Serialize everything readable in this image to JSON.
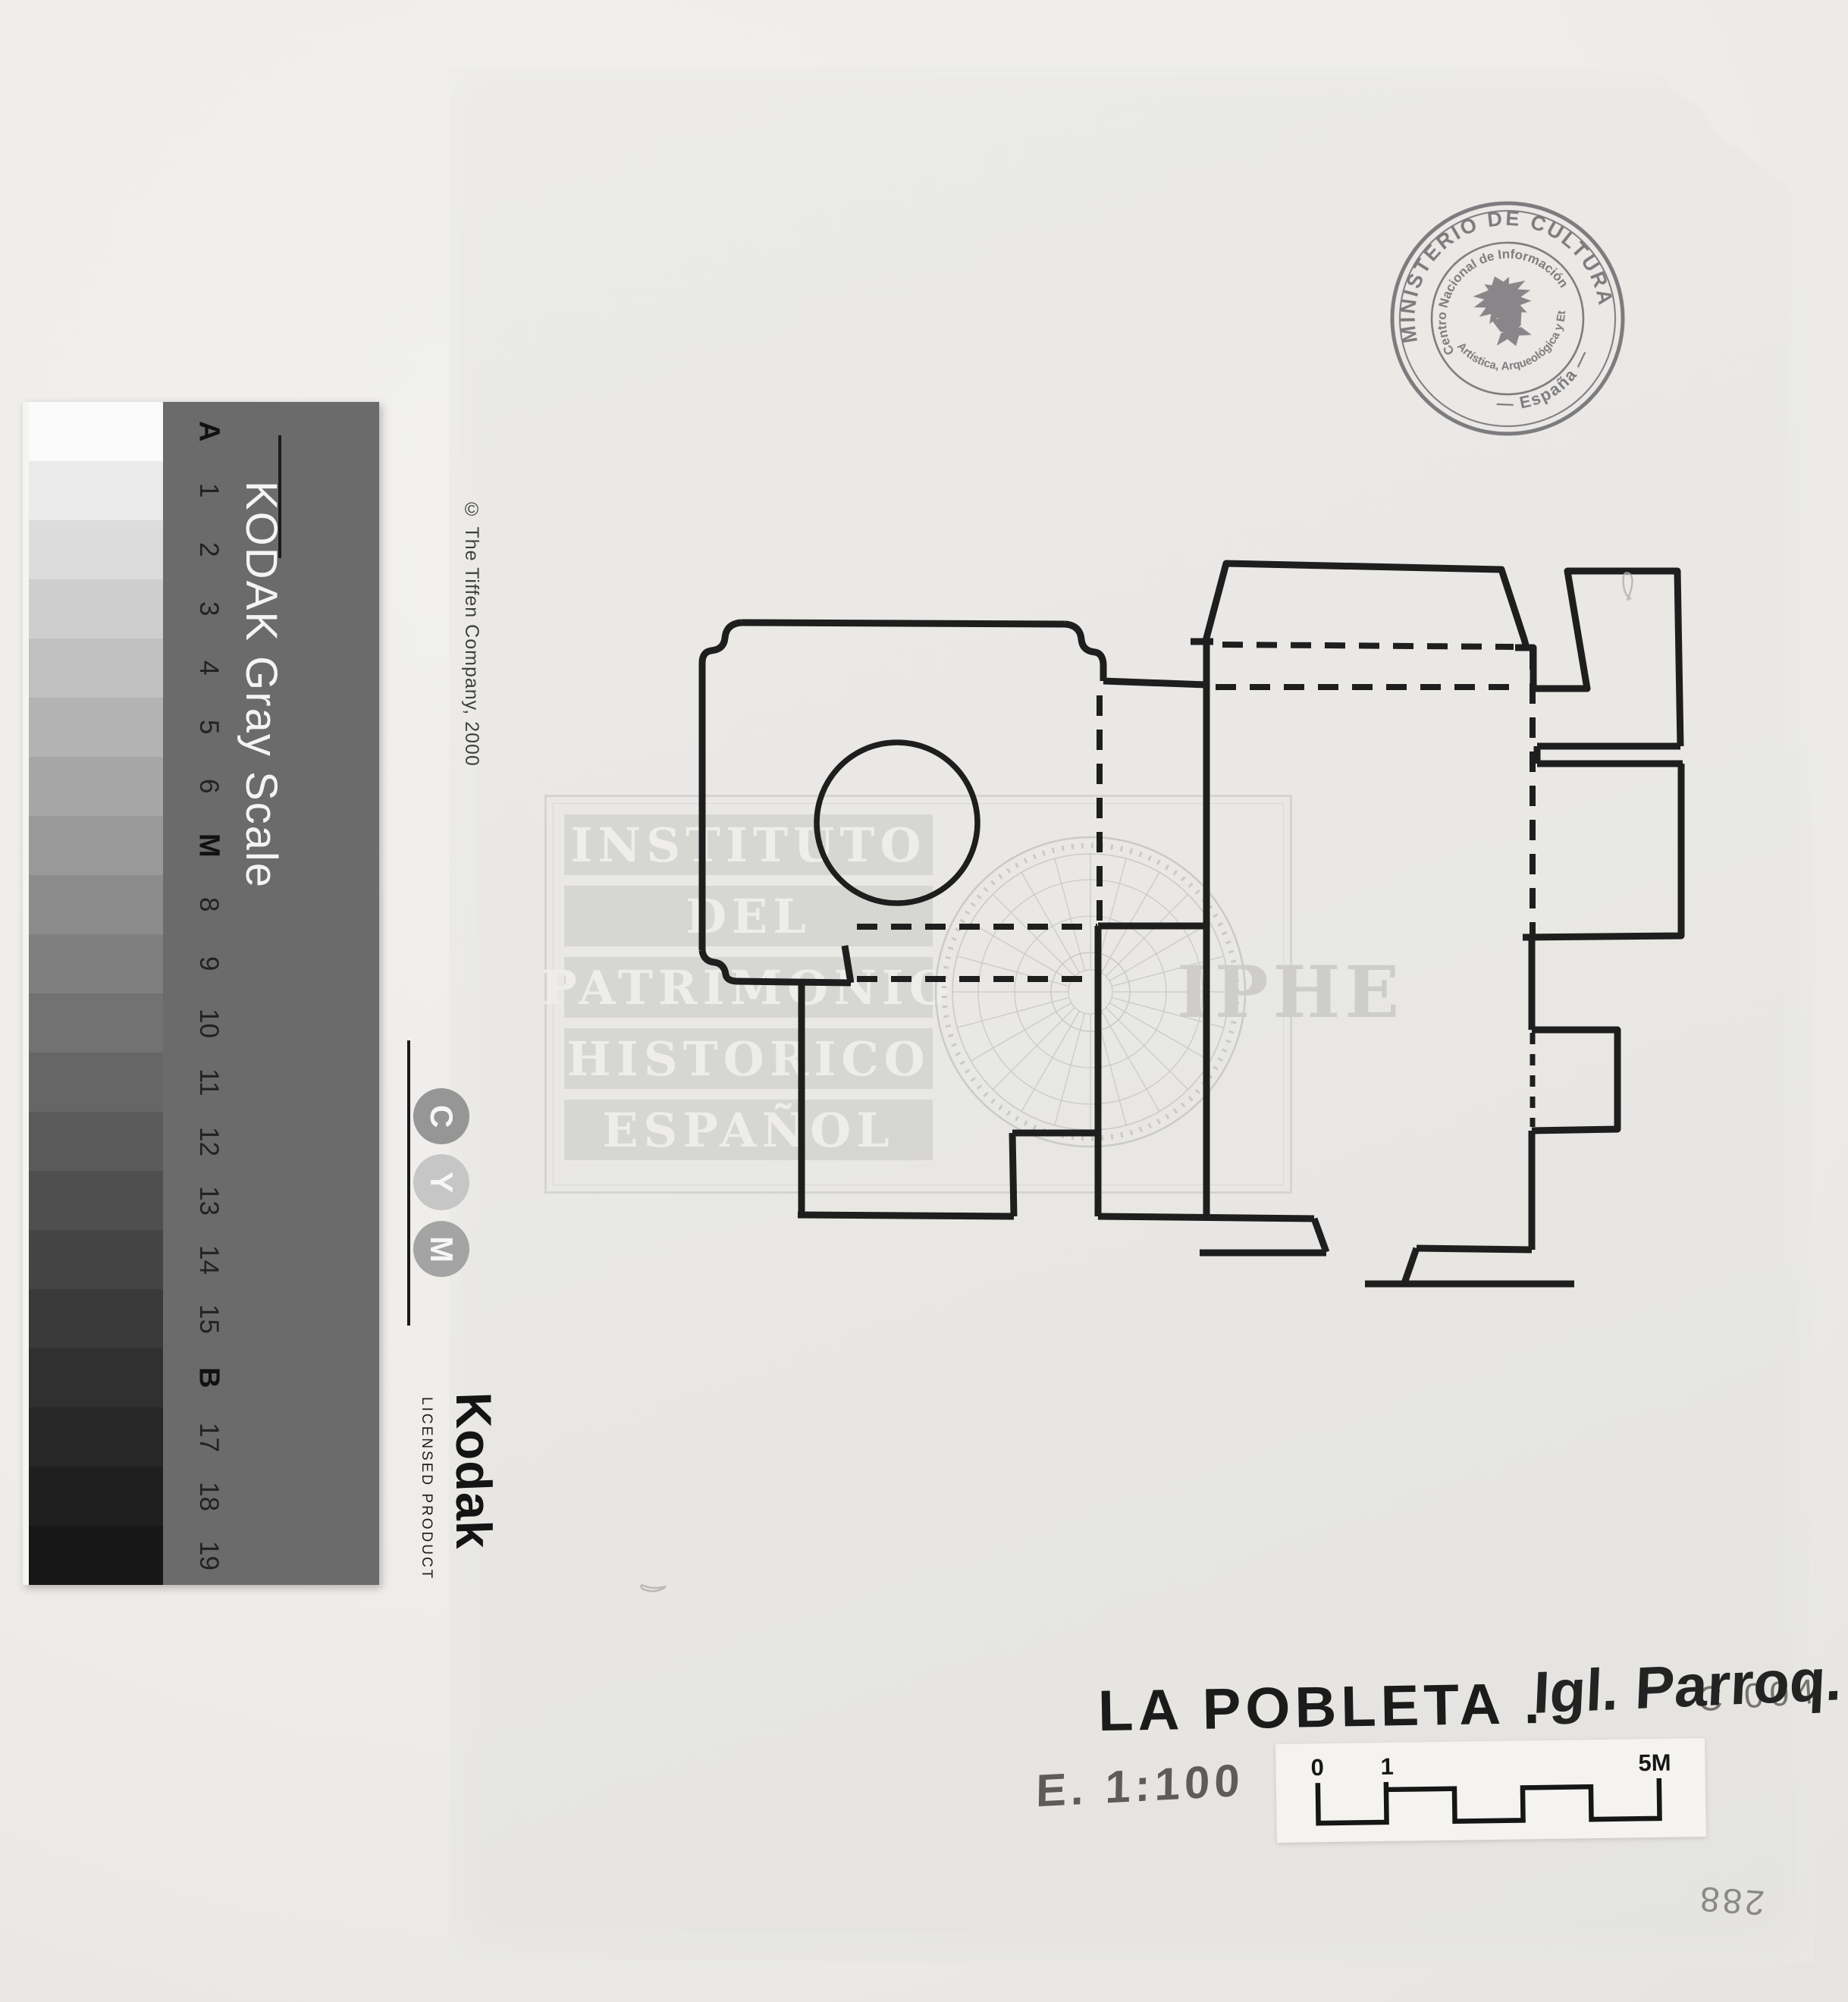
{
  "calibration_strip": {
    "title": "KODAK Gray Scale",
    "copyright": "© The Tiffen Company, 2000",
    "brand": "Kodak",
    "licensed": "LICENSED PRODUCT",
    "label_bg": "#6b6b6b",
    "cym": [
      {
        "letter": "C",
        "bg": "#969696"
      },
      {
        "letter": "Y",
        "bg": "#c6c6c6"
      },
      {
        "letter": "M",
        "bg": "#a4a4a4"
      }
    ],
    "labels": [
      {
        "text": "A",
        "bold": true
      },
      {
        "text": "1"
      },
      {
        "text": "2"
      },
      {
        "text": "3"
      },
      {
        "text": "4"
      },
      {
        "text": "5"
      },
      {
        "text": "6"
      },
      {
        "text": "M",
        "bold": true
      },
      {
        "text": "8"
      },
      {
        "text": "9"
      },
      {
        "text": "10"
      },
      {
        "text": "11"
      },
      {
        "text": "12"
      },
      {
        "text": "13"
      },
      {
        "text": "14"
      },
      {
        "text": "15"
      },
      {
        "text": "B",
        "bold": true
      },
      {
        "text": "17"
      },
      {
        "text": "18"
      },
      {
        "text": "19"
      }
    ],
    "patch_colors": [
      "#fbfbfb",
      "#eaeaea",
      "#dcdcdc",
      "#cecece",
      "#c0c0c0",
      "#b3b3b3",
      "#a6a6a6",
      "#999999",
      "#8c8c8c",
      "#7f7f7f",
      "#727272",
      "#666666",
      "#5a5a5a",
      "#4f4f4f",
      "#444444",
      "#3a3a3a",
      "#303030",
      "#272727",
      "#1f1f1f",
      "#171717"
    ]
  },
  "stamp": {
    "ring_top": "MINISTERIO DE CULTURA",
    "ring_bottom": "— España —",
    "inner_top": "Centro Nacional de Información",
    "inner_bottom": "Artística, Arqueológica y Etnológica",
    "ink": "#6e6c72"
  },
  "watermark": {
    "lines": [
      "INSTITUTO",
      "DEL",
      "PATRIMONIO",
      "HISTORICO",
      "ESPAÑOL"
    ],
    "acronym": "IPHE"
  },
  "plan": {
    "caption_title": "LA POBLETA .",
    "caption_subtitle": "Igl. Parroq.",
    "scale_note": "E. 1:100"
  },
  "scale_bar": {
    "tick_labels": [
      "0",
      "1",
      "5M"
    ]
  },
  "annotations": {
    "corner_code": "C 004",
    "inventory_number": "288"
  }
}
